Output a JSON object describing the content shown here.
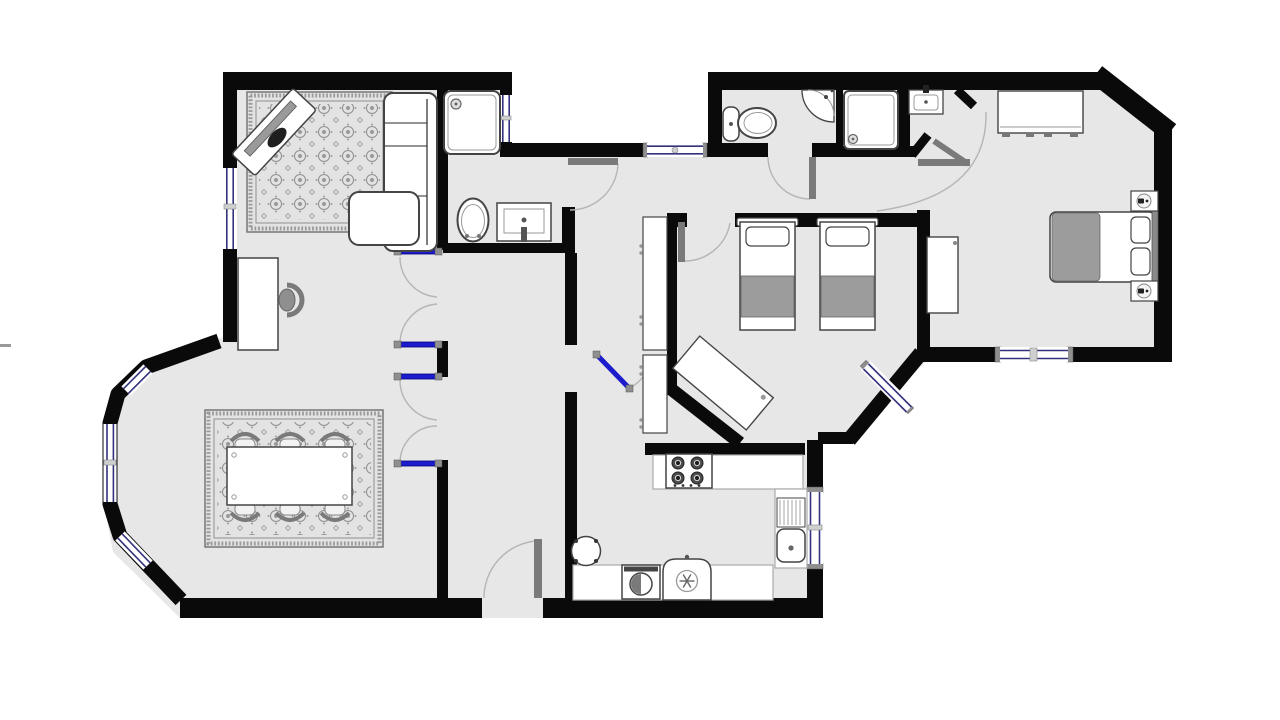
{
  "meta": {
    "type": "architectural-floor-plan",
    "description": "Top-down 2D floor plan of an apartment with living room, dining area, hallway, bathroom, WC, shower room, kitchen, twin bedroom and master bedroom",
    "visible_text": []
  },
  "colors": {
    "background": "#ffffff",
    "wall": "#0a0a0a",
    "floor": "#e7e7e7",
    "window_glass": "#ffffff",
    "window_line": "#32327d",
    "door_leaf_blue": "#1c1ccd",
    "door_leaf_gray": "#7a7a7a",
    "hinge_gray": "#8f8f8f",
    "swing_arc": "#b5b5b5",
    "fixture_fill": "#ffffff",
    "fixture_stroke": "#444444",
    "textile_gray": "#9c9c9c",
    "rug_field": "#e3e3e3",
    "rug_line": "#8f8f8f"
  },
  "plan": {
    "rooms": [
      {
        "id": "living-room",
        "furniture": [
          "patterned rug",
          "tv-on-stand (angled)",
          "corner sofa",
          "lounge chaise",
          "desk",
          "office chair"
        ],
        "openings": [
          "west window (2 panes)",
          "double french door to hallway"
        ]
      },
      {
        "id": "dining-area",
        "furniture": [
          "patterned rug",
          "dining table",
          "6 chairs"
        ],
        "openings": [
          "bay windows (3 segments)",
          "double french door to hallway"
        ]
      },
      {
        "id": "bathroom",
        "furniture": [
          "shower tray",
          "toilet",
          "vanity sink"
        ],
        "openings": [
          "window beside shower",
          "gray door to corridor"
        ]
      },
      {
        "id": "hallway",
        "furniture": [],
        "openings": [
          "front entrance door (south)",
          "blue door to kitchen passage"
        ]
      },
      {
        "id": "kitchen",
        "furniture": [
          "tall cabinets",
          "hob with 4 burners",
          "worktop with sink and drainer",
          "washing machine",
          "fridge",
          "round table"
        ],
        "openings": [
          "east window"
        ]
      },
      {
        "id": "wc",
        "furniture": [
          "toilet with cistern",
          "corner basin"
        ],
        "openings": [
          "gray door to corridor",
          "north corridor window"
        ]
      },
      {
        "id": "shower-room",
        "furniture": [
          "shower tray",
          "wall-hung sink"
        ],
        "openings": [
          "folding gray door"
        ]
      },
      {
        "id": "twin-bedroom",
        "furniture": [
          "single bed 1",
          "single bed 2",
          "angled desk"
        ],
        "openings": [
          "gray door to corridor",
          "chamfered corner window"
        ]
      },
      {
        "id": "master-bedroom",
        "furniture": [
          "double bed with gray duvet",
          "2 nightstands with sconce icons",
          "wardrobe",
          "dresser"
        ],
        "openings": [
          "south window",
          "entry arch from corridor"
        ]
      }
    ],
    "window_count": 10,
    "door_count": 10
  },
  "artifacts": {
    "left_edge_mark": "small gray dash at left image edge"
  }
}
